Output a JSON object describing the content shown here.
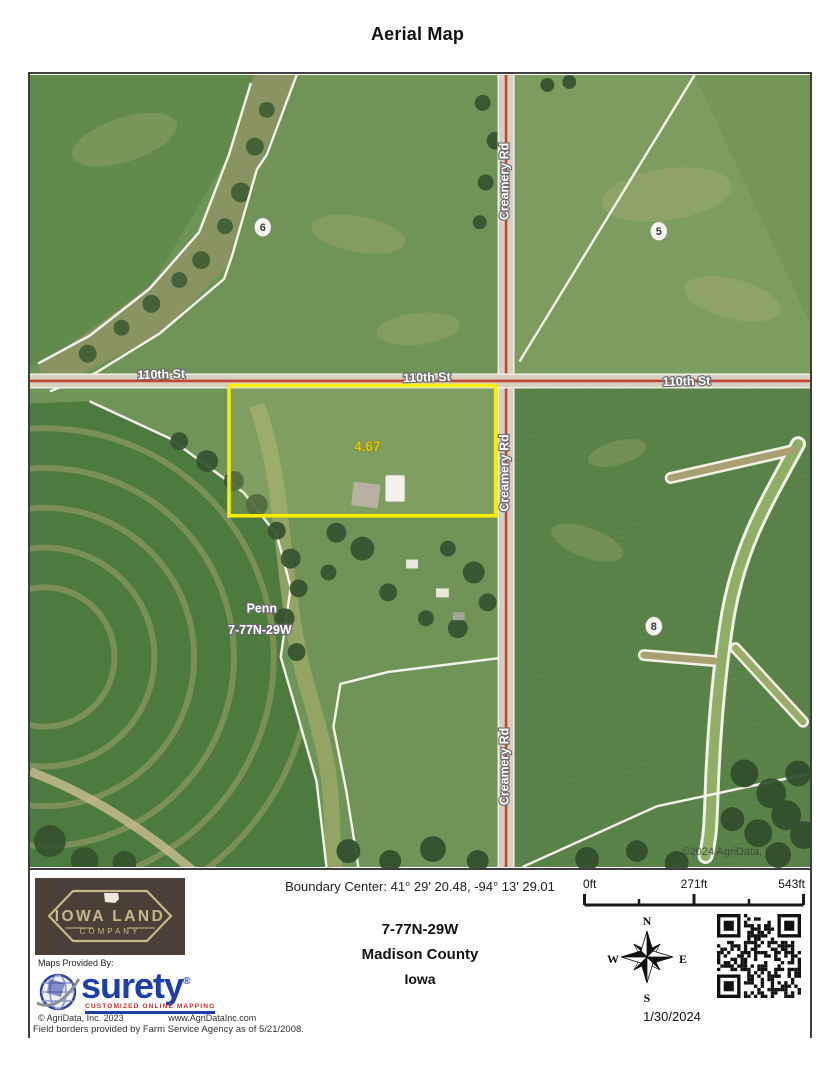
{
  "title": "Aerial Map",
  "map": {
    "road_h": "110th St",
    "road_v": "Creamery Rd",
    "parcel_acres": "4.67",
    "fields": {
      "f5": "5",
      "f6": "6",
      "f8": "8"
    },
    "township": {
      "name": "Penn",
      "trs": "7-77N-29W"
    },
    "copyright": "©2024 AgriData, Inc.",
    "colors": {
      "parcel_outline": "#f8ec00",
      "road_line": "#c44434",
      "field_boundary": "#f4f3ec"
    }
  },
  "footer": {
    "company_logo": {
      "line1": "IOWA LAND",
      "line2": "COMPANY"
    },
    "provider": {
      "label": "Maps Provided By:",
      "brand": "surety",
      "registered": "®",
      "tagline": "CUSTOMIZED ONLINE MAPPING",
      "copyright": "© AgriData, Inc. 2023",
      "website": "www.AgriDataInc.com"
    },
    "boundary_center": "Boundary Center: 41° 29' 20.48,  -94° 13' 29.01",
    "location": {
      "trs": "7-77N-29W",
      "county": "Madison County",
      "state": "Iowa"
    },
    "scale": {
      "start": "0ft",
      "mid": "271ft",
      "end": "543ft"
    },
    "compass": {
      "n": "N",
      "e": "E",
      "s": "S",
      "w": "W"
    },
    "date": "1/30/2024",
    "disclaimer": "Field borders provided by Farm Service Agency as of 5/21/2008."
  }
}
